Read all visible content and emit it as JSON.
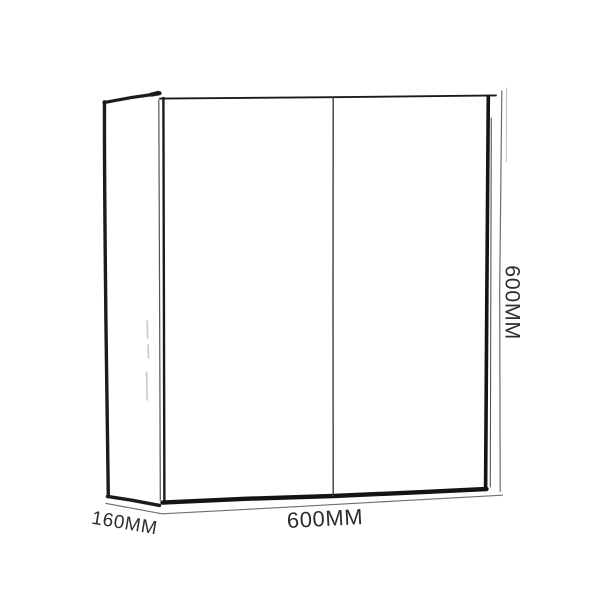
{
  "canvas": {
    "background": "#ffffff"
  },
  "diagram": {
    "colors": {
      "outline": "#1b1b1b",
      "outline_heavy": "#141414",
      "sketch_secondary": "#555555",
      "divider": "#3e3e3e",
      "dimension_line": "#6e6e6e",
      "ghost_line": "#bdbdbd",
      "faint_marks": "#c9c9c9",
      "label_text": "#2e2e2e"
    },
    "dimensions": {
      "height": {
        "label": "600MM"
      },
      "width": {
        "label": "600MM"
      },
      "depth": {
        "label": "160MM"
      }
    }
  }
}
